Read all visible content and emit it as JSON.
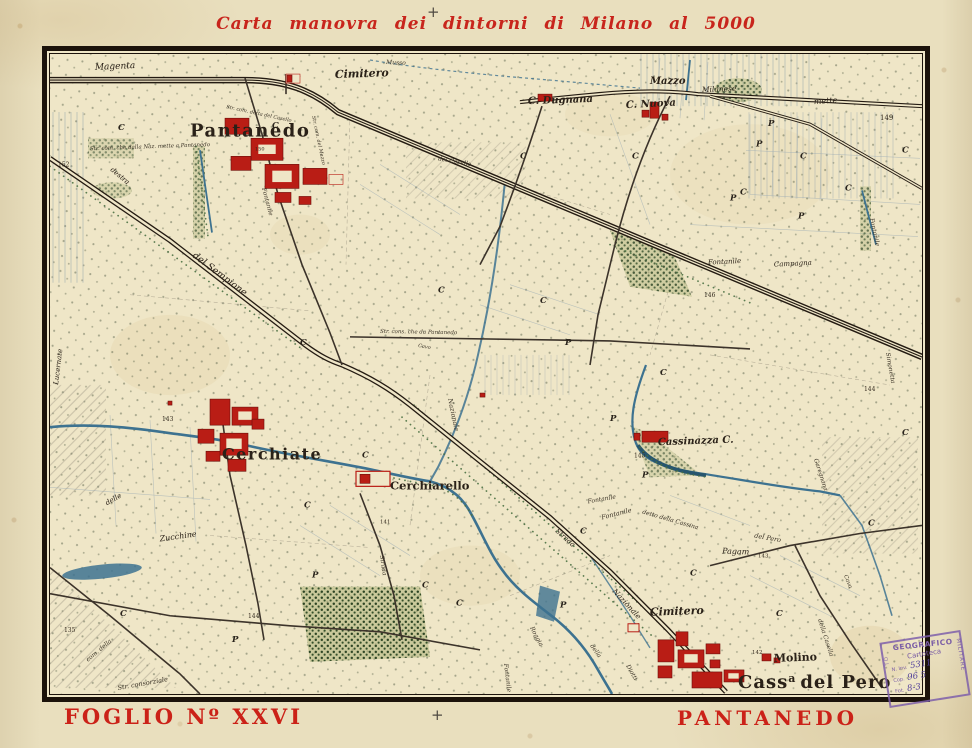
{
  "page": {
    "title": "Carta manovra dei dintorni di Milano al 5000",
    "top_cross": "+",
    "bottom_cross": "+",
    "sheet_label": "FOGLIO Nº XXVI",
    "place_label": "PANTANEDO"
  },
  "colors": {
    "title_red": "#c8251c",
    "paper": "#e9dfbe",
    "map_paper": "#efe6c7",
    "ink": "#2a2118",
    "water": "#3d7290",
    "vegetation": "#48693c",
    "building_red": "#b91d15",
    "stamp_purple": "#7b5ea6"
  },
  "stamp": {
    "arc": "GEOGRAFICO",
    "line2": "Cartoteca",
    "inv_label": "N. Inv.",
    "inv_value": "5311",
    "row1_label": "Cop.",
    "row1_value": "96 5",
    "row2_label": "Fot.",
    "row2_value": "8-3",
    "side_right": "MILITARE",
    "side_left": "TO"
  },
  "map": {
    "cass_label": {
      "prefix": "Cass",
      "sup": "a",
      "rest": "del Pero"
    },
    "labels": [
      {
        "t": "Magenta",
        "x": 45,
        "y": 16,
        "s": 9,
        "r": -3,
        "c": "it"
      },
      {
        "t": "Musso",
        "x": 336,
        "y": 10,
        "s": 6,
        "r": 2,
        "c": "tiny"
      },
      {
        "t": "Cimitero",
        "x": 285,
        "y": 24,
        "s": 11,
        "r": -2,
        "c": "name-it"
      },
      {
        "t": "Pantanedo",
        "x": 140,
        "y": 82,
        "s": 18,
        "r": 0,
        "c": "big"
      },
      {
        "t": "150",
        "x": 205,
        "y": 96,
        "s": 5,
        "r": 0,
        "c": "num"
      },
      {
        "t": "Str. com. che dalla Naz. mette a Pantanedo",
        "x": 40,
        "y": 96,
        "s": 5.5,
        "r": -2,
        "c": "tiny"
      },
      {
        "t": "Str. com. detta del Casello",
        "x": 176,
        "y": 54,
        "s": 5,
        "r": 12,
        "c": "tiny"
      },
      {
        "t": "del Casello",
        "x": 388,
        "y": 106,
        "s": 6,
        "r": 10,
        "c": "tiny"
      },
      {
        "t": "C. Dugnana",
        "x": 478,
        "y": 50,
        "s": 10,
        "r": -2,
        "c": "name-it"
      },
      {
        "t": "Mazzo",
        "x": 600,
        "y": 30,
        "s": 10,
        "r": 0,
        "c": "name-it"
      },
      {
        "t": "C. Nuova",
        "x": 576,
        "y": 54,
        "s": 10,
        "r": -3,
        "c": "name-it"
      },
      {
        "t": "Milanese",
        "x": 652,
        "y": 38,
        "s": 7.5,
        "r": -2,
        "c": "it"
      },
      {
        "t": "mette",
        "x": 764,
        "y": 50,
        "s": 8,
        "r": -4,
        "c": "it"
      },
      {
        "t": "149",
        "x": 830,
        "y": 66,
        "s": 7,
        "r": 0,
        "c": "num"
      },
      {
        "t": "Str. com. del Mazzo",
        "x": 262,
        "y": 62,
        "s": 5,
        "r": 78,
        "c": "tiny"
      },
      {
        "t": "Fontanile",
        "x": 212,
        "y": 134,
        "s": 6,
        "r": 75,
        "c": "tiny"
      },
      {
        "t": "del Sempione",
        "x": 142,
        "y": 202,
        "s": 9.5,
        "r": 37,
        "c": "it"
      },
      {
        "t": "destra",
        "x": 60,
        "y": 116,
        "s": 7,
        "r": 40,
        "c": "it"
      },
      {
        "t": "Fontanile",
        "x": 658,
        "y": 210,
        "s": 7,
        "r": -3,
        "c": "it"
      },
      {
        "t": "Campagna",
        "x": 724,
        "y": 212,
        "s": 7,
        "r": -3,
        "c": "it"
      },
      {
        "t": "146",
        "x": 654,
        "y": 242,
        "s": 6,
        "r": 0,
        "c": "num"
      },
      {
        "t": "Str. cons. che da Pantanedo",
        "x": 330,
        "y": 278,
        "s": 5.5,
        "r": 1,
        "c": "tiny"
      },
      {
        "t": "Cavo",
        "x": 368,
        "y": 292,
        "s": 5,
        "r": 10,
        "c": "tiny"
      },
      {
        "t": "Nazionale",
        "x": 398,
        "y": 344,
        "s": 6.5,
        "r": 78,
        "c": "tiny"
      },
      {
        "t": "Lucernate",
        "x": 8,
        "y": 330,
        "s": 7,
        "r": -83,
        "c": "it"
      },
      {
        "t": "152",
        "x": 8,
        "y": 112,
        "s": 6,
        "r": 0,
        "c": "num"
      },
      {
        "t": "143",
        "x": 112,
        "y": 366,
        "s": 6,
        "r": 0,
        "c": "num"
      },
      {
        "t": "Cerchiate",
        "x": 172,
        "y": 404,
        "s": 16,
        "r": 0,
        "c": "big"
      },
      {
        "t": "Cerchiarello",
        "x": 340,
        "y": 434,
        "s": 11.5,
        "r": 0,
        "c": "name"
      },
      {
        "t": "141",
        "x": 330,
        "y": 468,
        "s": 5.5,
        "r": 0,
        "c": "num"
      },
      {
        "t": "Strada",
        "x": 330,
        "y": 500,
        "s": 6,
        "r": 82,
        "c": "tiny"
      },
      {
        "t": "Zucchine",
        "x": 110,
        "y": 486,
        "s": 8,
        "r": -8,
        "c": "it"
      },
      {
        "t": "delle",
        "x": 57,
        "y": 450,
        "s": 7,
        "r": -30,
        "c": "it"
      },
      {
        "t": "135",
        "x": 14,
        "y": 576,
        "s": 6,
        "r": 0,
        "c": "num"
      },
      {
        "t": "144",
        "x": 198,
        "y": 562,
        "s": 6,
        "r": 0,
        "c": "num"
      },
      {
        "t": "com. della",
        "x": 38,
        "y": 606,
        "s": 6,
        "r": -40,
        "c": "tiny"
      },
      {
        "t": "Str. consorziale",
        "x": 68,
        "y": 634,
        "s": 6.5,
        "r": -10,
        "c": "tiny"
      },
      {
        "t": "Cassinazza C.",
        "x": 608,
        "y": 390,
        "s": 10,
        "r": -2,
        "c": "name-it"
      },
      {
        "t": "145",
        "x": 584,
        "y": 402,
        "s": 6,
        "r": 0,
        "c": "num"
      },
      {
        "t": "Fontanile",
        "x": 538,
        "y": 448,
        "s": 6,
        "r": -10,
        "c": "tiny"
      },
      {
        "t": "Fontanile",
        "x": 552,
        "y": 464,
        "s": 6.5,
        "r": -14,
        "c": "tiny"
      },
      {
        "t": "detto della Cassina",
        "x": 592,
        "y": 458,
        "s": 6,
        "r": 16,
        "c": "tiny"
      },
      {
        "t": "del Pero",
        "x": 704,
        "y": 482,
        "s": 6.5,
        "r": 10,
        "c": "tiny"
      },
      {
        "t": "Pagam",
        "x": 672,
        "y": 498,
        "s": 8,
        "r": 2,
        "c": "it"
      },
      {
        "t": "143",
        "x": 708,
        "y": 502,
        "s": 5.5,
        "r": 0,
        "c": "num"
      },
      {
        "t": "Strada",
        "x": 505,
        "y": 476,
        "s": 7,
        "r": 42,
        "c": "it"
      },
      {
        "t": "Roggia",
        "x": 480,
        "y": 572,
        "s": 6,
        "r": 62,
        "c": "tiny"
      },
      {
        "t": "della",
        "x": 540,
        "y": 590,
        "s": 6,
        "r": 55,
        "c": "tiny"
      },
      {
        "t": "Diotti",
        "x": 576,
        "y": 610,
        "s": 6,
        "r": 60,
        "c": "tiny"
      },
      {
        "t": "Fontanile",
        "x": 454,
        "y": 608,
        "s": 6,
        "r": 83,
        "c": "tiny"
      },
      {
        "t": "Nazionale",
        "x": 562,
        "y": 536,
        "s": 7.5,
        "r": 47,
        "c": "it"
      },
      {
        "t": "Cimitero",
        "x": 600,
        "y": 560,
        "s": 11,
        "r": -2,
        "c": "name-it"
      },
      {
        "t": "Molino",
        "x": 724,
        "y": 606,
        "s": 11,
        "r": -2,
        "c": "name"
      },
      {
        "t": "142",
        "x": 702,
        "y": 598,
        "s": 5.5,
        "r": 0,
        "c": "num"
      },
      {
        "t": "Garegnana",
        "x": 764,
        "y": 404,
        "s": 6,
        "r": 72,
        "c": "tiny"
      },
      {
        "t": "Simonetta",
        "x": 836,
        "y": 298,
        "s": 6,
        "r": 80,
        "c": "tiny"
      },
      {
        "t": "Fontanile",
        "x": 820,
        "y": 164,
        "s": 6,
        "r": 78,
        "c": "tiny"
      },
      {
        "t": "144",
        "x": 814,
        "y": 336,
        "s": 6,
        "r": 0,
        "c": "num"
      },
      {
        "t": "della Casella",
        "x": 768,
        "y": 564,
        "s": 6,
        "r": 72,
        "c": "tiny"
      },
      {
        "t": "Cava",
        "x": 794,
        "y": 520,
        "s": 5.5,
        "r": 68,
        "c": "tiny"
      }
    ],
    "letters": [
      {
        "t": "C",
        "x": 68,
        "y": 76
      },
      {
        "t": "C",
        "x": 222,
        "y": 74
      },
      {
        "t": "C",
        "x": 470,
        "y": 104
      },
      {
        "t": "C",
        "x": 582,
        "y": 104
      },
      {
        "t": "C",
        "x": 690,
        "y": 140
      },
      {
        "t": "C",
        "x": 750,
        "y": 104
      },
      {
        "t": "C",
        "x": 795,
        "y": 136
      },
      {
        "t": "C",
        "x": 852,
        "y": 98
      },
      {
        "t": "C",
        "x": 250,
        "y": 290
      },
      {
        "t": "C",
        "x": 388,
        "y": 238
      },
      {
        "t": "C",
        "x": 490,
        "y": 248
      },
      {
        "t": "C",
        "x": 312,
        "y": 402
      },
      {
        "t": "C",
        "x": 372,
        "y": 532
      },
      {
        "t": "C",
        "x": 406,
        "y": 550
      },
      {
        "t": "C",
        "x": 530,
        "y": 478
      },
      {
        "t": "C",
        "x": 640,
        "y": 520
      },
      {
        "t": "C",
        "x": 726,
        "y": 560
      },
      {
        "t": "C",
        "x": 818,
        "y": 470
      },
      {
        "t": "C",
        "x": 852,
        "y": 380
      },
      {
        "t": "C",
        "x": 254,
        "y": 452
      },
      {
        "t": "C",
        "x": 610,
        "y": 320
      },
      {
        "t": "C",
        "x": 70,
        "y": 560
      },
      {
        "t": "P",
        "x": 515,
        "y": 290
      },
      {
        "t": "P",
        "x": 560,
        "y": 366
      },
      {
        "t": "P",
        "x": 592,
        "y": 422
      },
      {
        "t": "P",
        "x": 680,
        "y": 146
      },
      {
        "t": "P",
        "x": 748,
        "y": 164
      },
      {
        "t": "P",
        "x": 718,
        "y": 72
      },
      {
        "t": "P",
        "x": 510,
        "y": 552
      },
      {
        "t": "P",
        "x": 262,
        "y": 522
      },
      {
        "t": "P",
        "x": 182,
        "y": 586
      },
      {
        "t": "P",
        "x": 706,
        "y": 92
      }
    ]
  }
}
